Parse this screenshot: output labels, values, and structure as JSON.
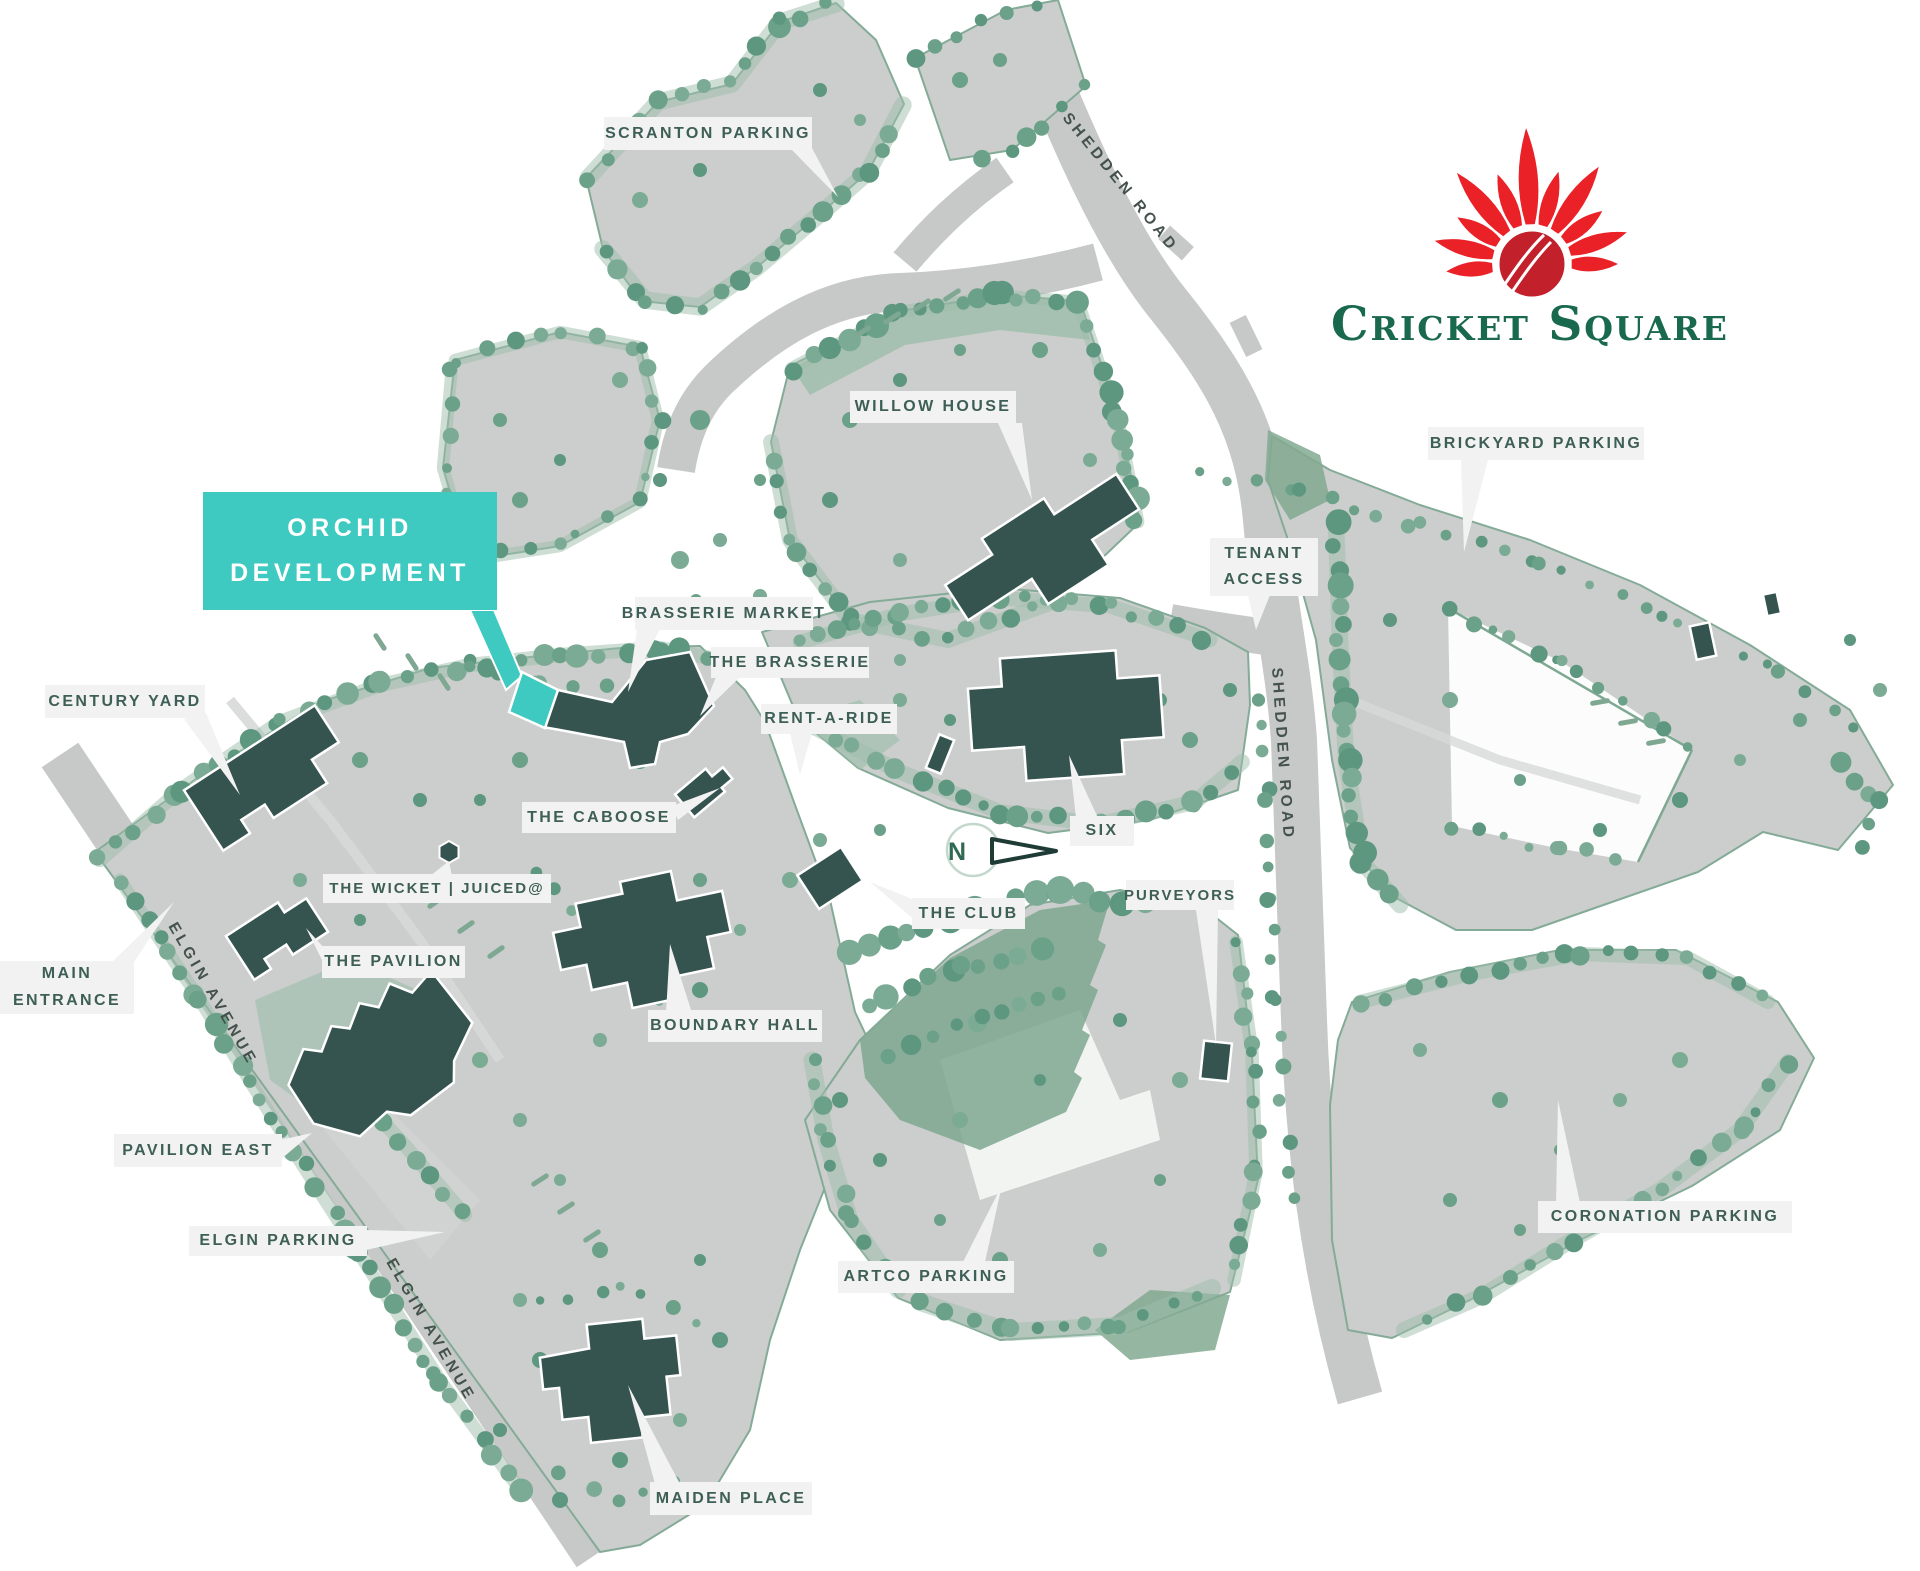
{
  "logo": {
    "name": "Cricket Square"
  },
  "compass": {
    "north": "N"
  },
  "roads": {
    "shedden_top": "SHEDDEN ROAD",
    "shedden_side": "SHEDDEN ROAD",
    "elgin_upper": "ELGIN AVENUE",
    "elgin_lower": "ELGIN AVENUE"
  },
  "highlight": {
    "line1": "ORCHID",
    "line2": "DEVELOPMENT"
  },
  "labels": {
    "scranton": "SCRANTON PARKING",
    "willow": "WILLOW HOUSE",
    "brickyard": "BRICKYARD PARKING",
    "tenant1": "TENANT",
    "tenant2": "ACCESS",
    "brasserie_market": "BRASSERIE MARKET",
    "the_brasserie": "THE BRASSERIE",
    "rent_a_ride": "RENT-A-RIDE",
    "century_yard": "CENTURY YARD",
    "caboose": "THE CABOOSE",
    "wicket": "THE WICKET | JUICED@",
    "main1": "MAIN",
    "main2": "ENTRANCE",
    "pavilion": "THE PAVILION",
    "boundary_hall": "BOUNDARY HALL",
    "six": "SIX",
    "club": "THE CLUB",
    "purveyors": "PURVEYORS",
    "pavilion_east": "PAVILION EAST",
    "elgin_parking": "ELGIN PARKING",
    "artco": "ARTCO PARKING",
    "maiden": "MAIDEN PLACE",
    "coronation": "CORONATION PARKING"
  },
  "colors": {
    "building": "#35534F",
    "highlight_teal": "#3EC9C1",
    "parcel": "#CBCECC",
    "road": "#C6C9C7",
    "tree": "#6CA189",
    "label_bg": "#F1F2F1",
    "label_text": "#3E5F56",
    "logo_red": "#EA2127",
    "logo_green": "#19694F"
  }
}
